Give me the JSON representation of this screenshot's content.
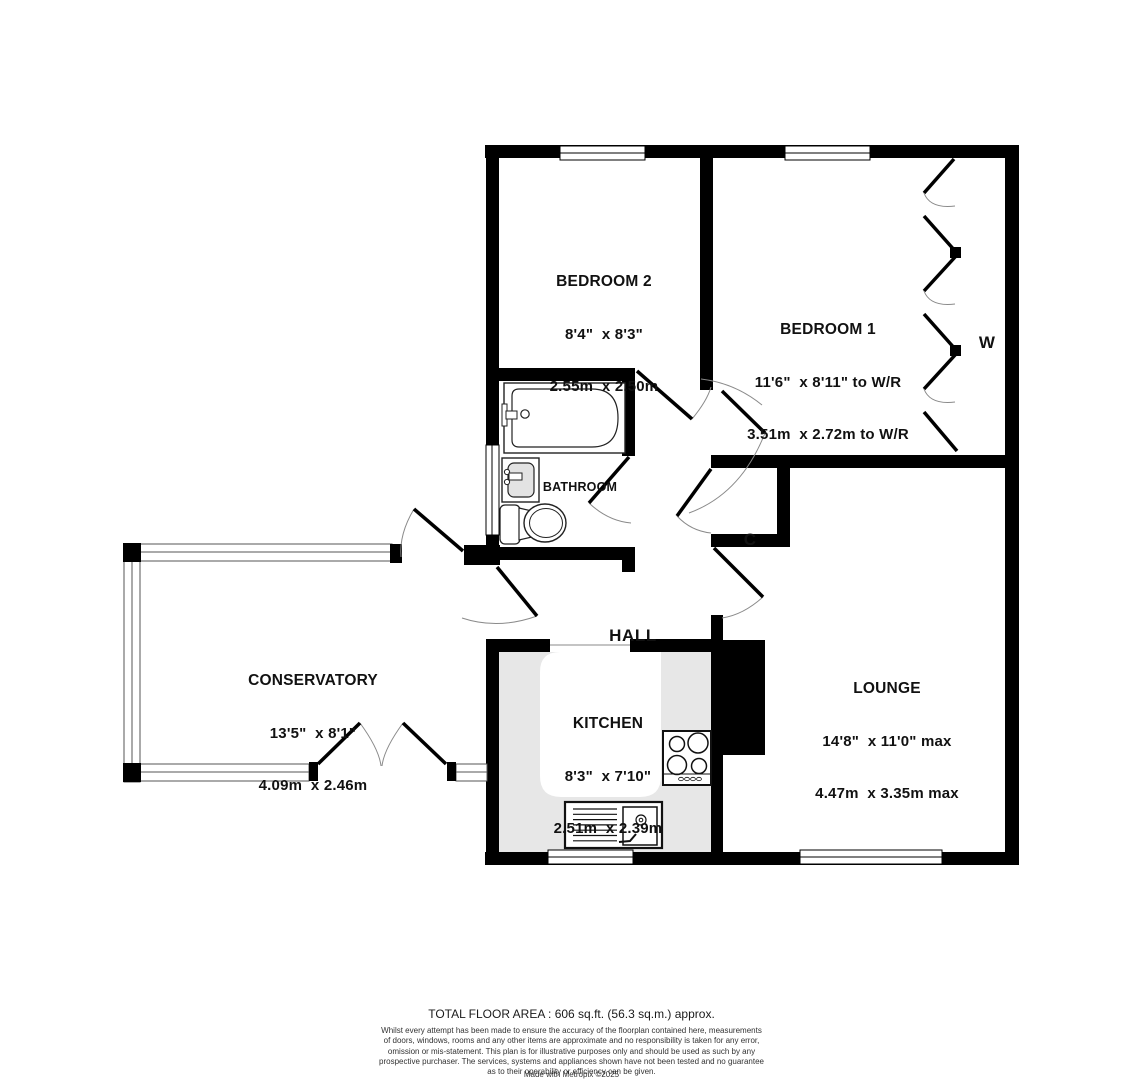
{
  "floorplan": {
    "title": "floor-plan",
    "rooms": {
      "bedroom2": {
        "name": "BEDROOM 2",
        "dims_imperial": "8'4\"  x 8'3\"",
        "dims_metric": "2.55m  x 2.50m"
      },
      "bedroom1": {
        "name": "BEDROOM 1",
        "dims_imperial": "11'6\"  x 8'11\" to W/R",
        "dims_metric": "3.51m  x 2.72m to W/R"
      },
      "bathroom": {
        "name": "BATHROOM"
      },
      "hall": {
        "name": "HALL"
      },
      "closet": {
        "name": "C"
      },
      "wardrobe": {
        "name": "W"
      },
      "conservatory": {
        "name": "CONSERVATORY",
        "dims_imperial": "13'5\"  x 8'1\"",
        "dims_metric": "4.09m  x 2.46m"
      },
      "kitchen": {
        "name": "KITCHEN",
        "dims_imperial": "8'3\"  x 7'10\"",
        "dims_metric": "2.51m  x 2.39m"
      },
      "lounge": {
        "name": "LOUNGE",
        "dims_imperial": "14'8\"  x 11'0\" max",
        "dims_metric": "4.47m  x 3.35m max"
      }
    },
    "colors": {
      "wall": "#000000",
      "counter": "#e7e7e7",
      "background": "#ffffff"
    }
  },
  "footer": {
    "total_area": "TOTAL FLOOR AREA : 606 sq.ft. (56.3 sq.m.) approx.",
    "disclaimer_lines": [
      "Whilst every attempt has been made to ensure the accuracy of the floorplan contained here, measurements",
      "of doors, windows, rooms and any other items are approximate and no responsibility is taken for any error,",
      "omission or mis-statement. This plan is for illustrative purposes only and should be used as such by any",
      "prospective purchaser. The services, systems and appliances shown have not been tested and no guarantee",
      "as to their operability or efficiency can be given."
    ],
    "credit": "Made with Metropix ©2025"
  }
}
